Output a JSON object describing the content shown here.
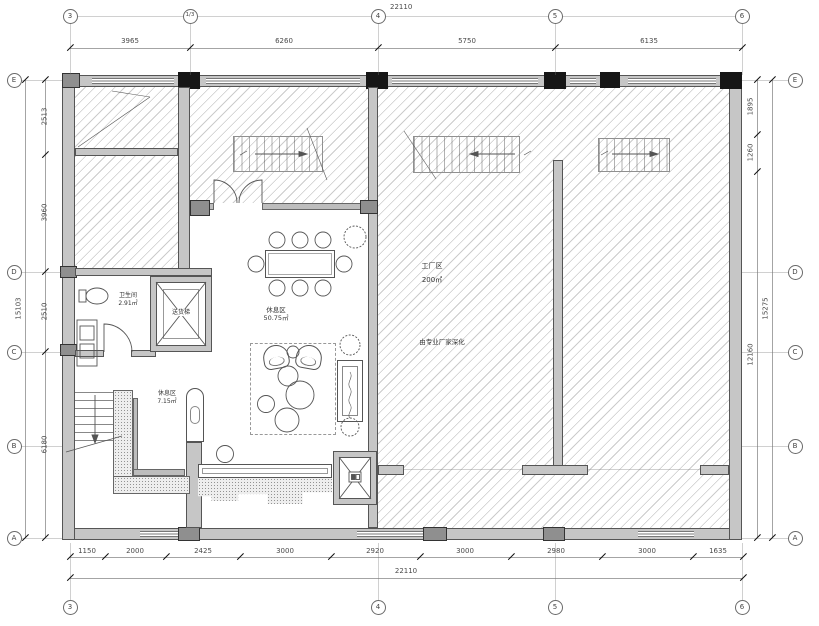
{
  "grid": {
    "top": [
      "3",
      "1/3",
      "4",
      "5",
      "6"
    ],
    "bottom": [
      "3",
      "4",
      "5",
      "6"
    ],
    "left": [
      "E",
      "D",
      "C",
      "B",
      "A"
    ],
    "right": [
      "E",
      "D",
      "C",
      "B",
      "A"
    ]
  },
  "dims": {
    "top_total": "22110",
    "top_segs": [
      "3965",
      "6260",
      "5750",
      "6135"
    ],
    "bottom_segs": [
      "1150",
      "2000",
      "2425",
      "3000",
      "2920",
      "3000",
      "2980",
      "3000",
      "1635"
    ],
    "bottom_total": "22110",
    "left_segs": [
      "2513",
      "3960",
      "2510",
      "6180"
    ],
    "left_total": "15103",
    "right_segs": [
      "1895",
      "1260",
      "12160"
    ],
    "right_total": "15275"
  },
  "rooms": {
    "toilet": {
      "name": "卫生间",
      "area": "2.91㎡"
    },
    "elevator": {
      "name": "送货梯"
    },
    "lounge": {
      "name": "休息区",
      "area": "50.75㎡"
    },
    "rest": {
      "name": "休息区",
      "area": "7.15㎡"
    },
    "factory": {
      "name": "工厂区",
      "area": "200㎡",
      "note": "由专业厂家深化"
    }
  }
}
